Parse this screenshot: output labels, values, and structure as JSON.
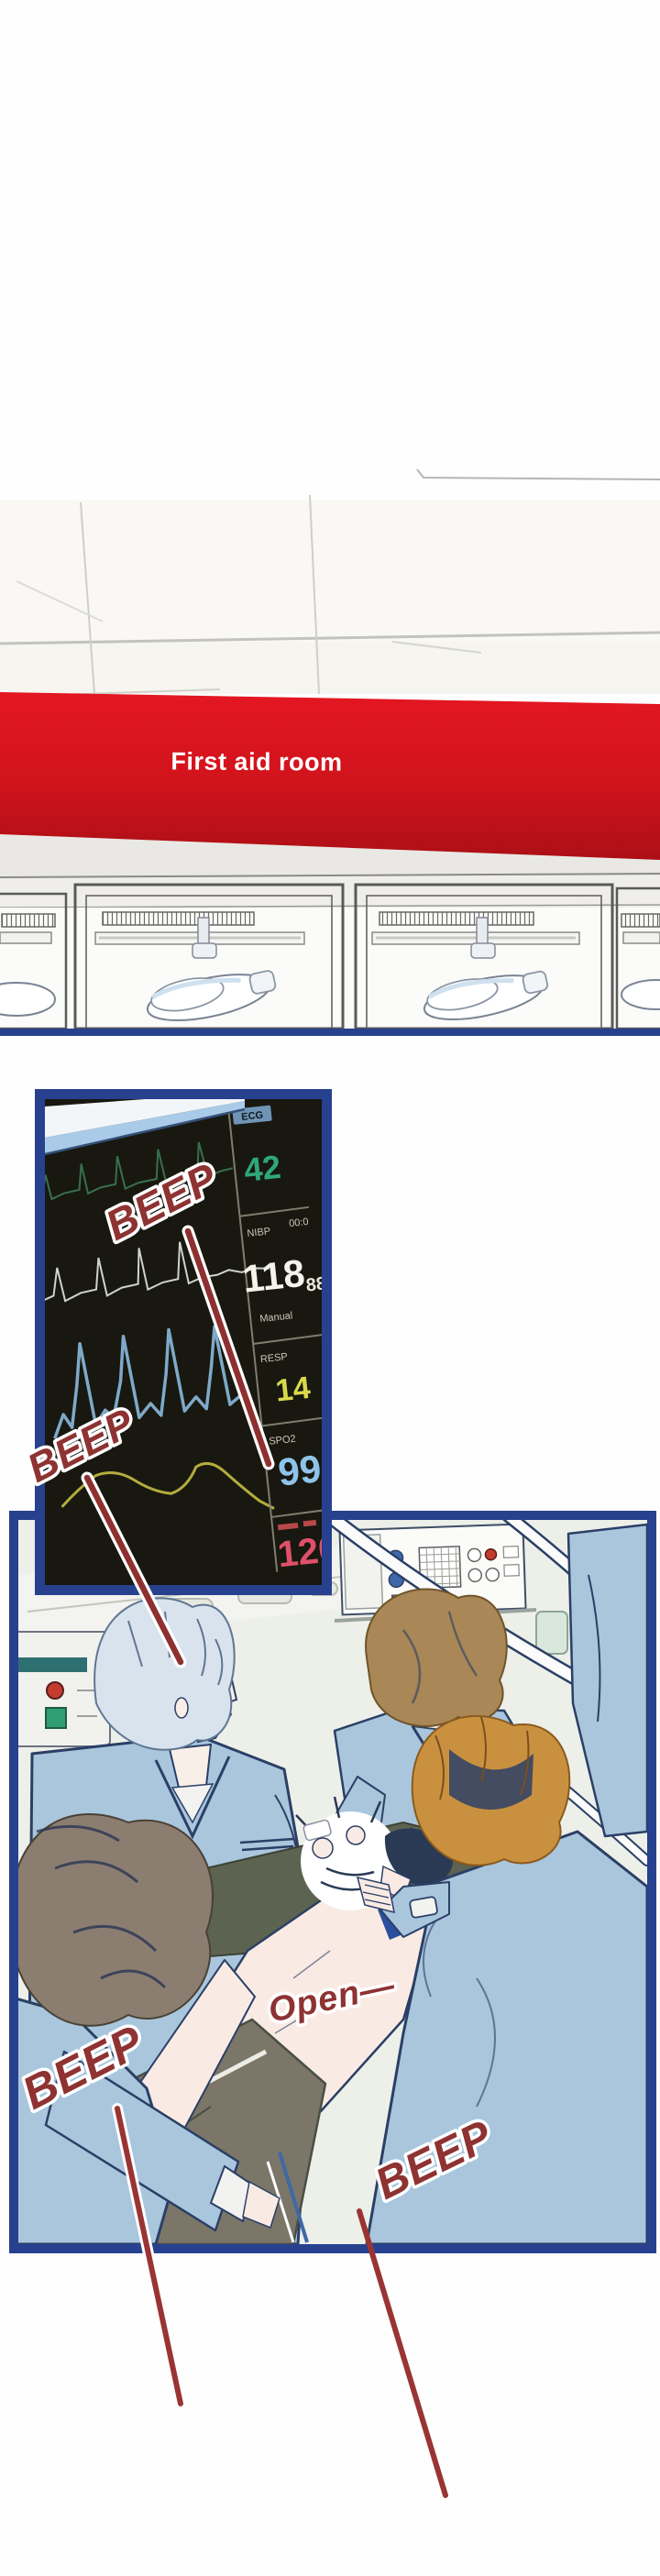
{
  "banner": {
    "label": "First aid room"
  },
  "monitor": {
    "ecg_label": "ECG",
    "ecg_value": "42",
    "nibp_label": "NIBP",
    "nibp_time": "00:0",
    "nibp_value": "118",
    "nibp_secondary": "88",
    "nibp_mode": "Manual",
    "resp_label": "RESP",
    "resp_value": "14",
    "spo2_label": "SPO2",
    "spo2_value": "99",
    "pulse_value": "120"
  },
  "sfx": {
    "beep_monitor_top": "BEEP",
    "beep_monitor_left": "BEEP",
    "beep_bottom_left": "BEEP",
    "beep_bottom_right": "BEEP",
    "open": "Open—"
  },
  "colors": {
    "banner_red": "#d0131c",
    "panel_border_navy": "#27418f",
    "sfx_red": "#8e3232",
    "scrubs_blue": "#a9c6dd",
    "ecg_green": "#2fa878",
    "resp_yellow": "#d8d94a",
    "spo2_blue": "#8ec4ea",
    "pulse_red": "#e0506a",
    "screen_dark": "#181810"
  },
  "icons": [
    "ceiling-grid",
    "door-window",
    "surgical-lamp",
    "ecg-trace-green",
    "ecg-trace-white",
    "ecg-trace-blue",
    "ecg-trace-yellow",
    "sound-line",
    "wall-outlet-panel",
    "impact-burst"
  ]
}
